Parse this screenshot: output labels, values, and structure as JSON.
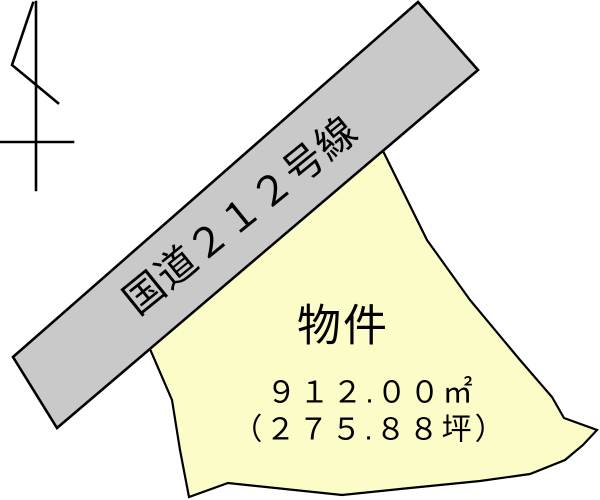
{
  "map": {
    "background": "#ffffff",
    "compass": {
      "icon": "north-arrow-icon",
      "stroke": "#000000"
    },
    "road": {
      "label": "国道２１２号線",
      "fill": "#c9c9c9",
      "stroke": "#000000"
    },
    "parcel": {
      "label": "物件",
      "area_m2": "９１２.００㎡",
      "area_tsubo": "（２７５.８８坪）",
      "fill": "#fcfcc8",
      "stroke": "#000000"
    }
  }
}
